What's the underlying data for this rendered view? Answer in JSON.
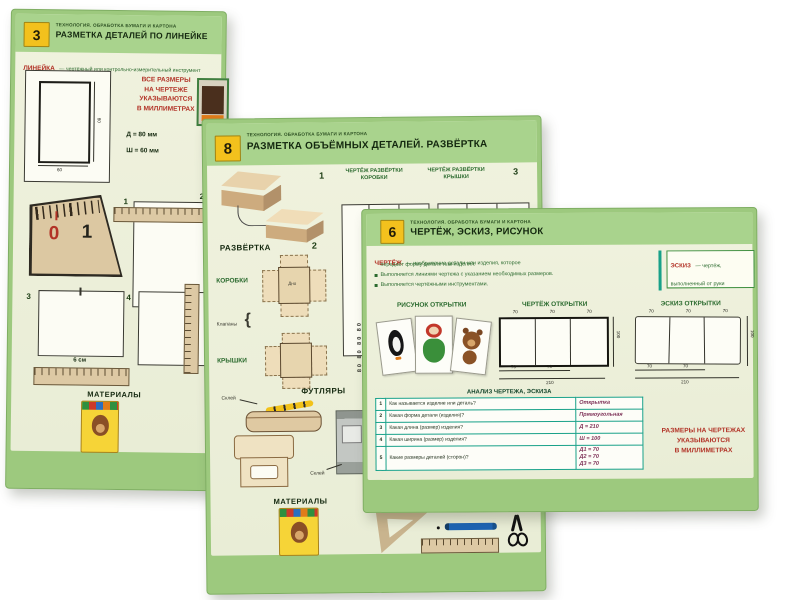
{
  "colors": {
    "frame_green": "#9dc97e",
    "header_green": "#a9d38d",
    "cream": "#edf0da",
    "accent_red": "#b23327",
    "accent_green": "#2c6b2f",
    "table_teal": "#18a189",
    "tab_yellow": "#f3c11d"
  },
  "series_line": "ТЕХНОЛОГИЯ. ОБРАБОТКА БУМАГИ И КАРТОНА",
  "poster3": {
    "number": "3",
    "title": "РАЗМЕТКА ДЕТАЛЕЙ ПО ЛИНЕЙКЕ",
    "term": "ЛИНЕЙКА",
    "term_def": "— чертёжный или контрольно-измерительный инструмент",
    "note_l1": "ВСЕ РАЗМЕРЫ",
    "note_l2": "НА ЧЕРТЕЖЕ",
    "note_l3": "УКАЗЫВАЮТСЯ",
    "note_l4": "В МИЛЛИМЕТРАХ",
    "dim_length": "Д = 80 мм",
    "dim_width": "Ш = 60 мм",
    "rect_w": "60",
    "rect_h": "80",
    "ruler_0": "0",
    "ruler_1": "1",
    "step_1": "1",
    "step_2": "2",
    "step_3": "3",
    "step_4": "4",
    "measure": "6 см",
    "materials": "МАТЕРИАЛЫ"
  },
  "poster8": {
    "number": "8",
    "title": "РАЗМЕТКА ОБЪЁМНЫХ ДЕТАЛЕЙ. РАЗВЁРТКА",
    "step_1": "1",
    "step_2": "2",
    "step_3": "3",
    "col_box": "ЧЕРТЁЖ РАЗВЁРТКИ КОРОБКИ",
    "col_lid": "ЧЕРТЁЖ РАЗВЁРТКИ КРЫШКИ",
    "razvertka": "РАЗВЁРТКА",
    "box_label": "КОРОБКИ",
    "lid_label": "КРЫШКИ",
    "flaps": "Клапаны",
    "bottom_label": "Дно",
    "dims_col": "80 80 80 80",
    "futlyary": "ФУТЛЯРЫ",
    "glue1": "Склей",
    "glue2": "Склей",
    "materials": "МАТЕРИАЛЫ"
  },
  "poster6": {
    "number": "6",
    "title": "ЧЕРТЁЖ, ЭСКИЗ, РИСУНОК",
    "term": "ЧЕРТЁЖ",
    "def_l1": "— изображение детали или изделия, которое",
    "def_l2": "передаёт форму детали или изделия.",
    "def_l3": "Выполняется линиями чертежа с указанием необходимых размеров.",
    "def_l4": "Выполняется чертёжными инструментами.",
    "sketch_term": "ЭСКИЗ",
    "sketch_def": "— чертёж, выполненный от руки",
    "col1": "РИСУНОК ОТКРЫТКИ",
    "col2": "ЧЕРТЁЖ ОТКРЫТКИ",
    "col3": "ЭСКИЗ ОТКРЫТКИ",
    "dims": {
      "seg": "70",
      "total": "210",
      "height": "100"
    },
    "table_title": "АНАЛИЗ ЧЕРТЕЖА, ЭСКИЗА",
    "rows": [
      {
        "n": "1",
        "q": "Как называется изделие или деталь?",
        "a": "Открытка"
      },
      {
        "n": "2",
        "q": "Какая форма детали (изделия)?",
        "a": "Прямоугольная"
      },
      {
        "n": "3",
        "q": "Какая длина (размер) изделия?",
        "a": "Д = 210"
      },
      {
        "n": "4",
        "q": "Какая ширина (размер) изделия?",
        "a": "Ш = 100"
      },
      {
        "n": "5",
        "q": "Какие размеры деталей (сторон)?",
        "a1": "Д1 = 70",
        "a2": "Д2 = 70",
        "a3": "Д3 = 70"
      }
    ],
    "note_l1": "РАЗМЕРЫ НА ЧЕРТЕЖАХ",
    "note_l2": "УКАЗЫВАЮТСЯ",
    "note_l3": "В МИЛЛИМЕТРАХ"
  }
}
